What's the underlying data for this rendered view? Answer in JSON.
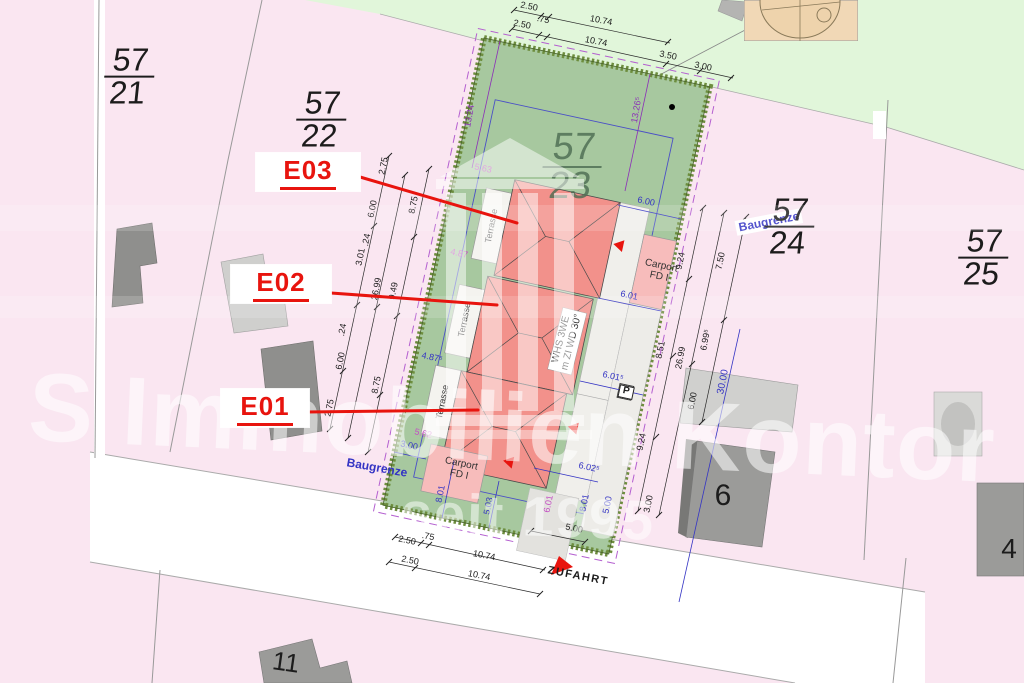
{
  "colors": {
    "ink": "#1c1c1c",
    "ink2": "#333333",
    "blue": "#3434c4",
    "purple": "#8c2fb8",
    "magenta": "#c44fc4",
    "red": "#e8140e",
    "green_label": "#4b6b51",
    "pink_parcel": "#fae6f1",
    "green_area": "#e1f6da",
    "lawn": "#a7c89f",
    "hedge": "#6d8d3e",
    "roof": "#f2918b",
    "carport": "#f7bcbb",
    "building_dark": "#9b9b99",
    "building_light": "#d0d0ce",
    "street": "#ffffff"
  },
  "watermark": {
    "brand": "S Immobilien Kontor",
    "since": "seit 1995"
  },
  "parcels": [
    {
      "n": "parcel-label-57-21",
      "num": "57",
      "den": "21",
      "x": 129,
      "y": 77,
      "s": 32,
      "c": "#1c1c1c",
      "o": 1
    },
    {
      "n": "parcel-label-57-22",
      "num": "57",
      "den": "22",
      "x": 321,
      "y": 120,
      "s": 32,
      "c": "#1c1c1c",
      "o": 1
    },
    {
      "n": "parcel-label-57-23",
      "num": "57",
      "den": "23",
      "x": 572,
      "y": 167,
      "s": 38,
      "c": "#4b6b51",
      "o": 0.8
    },
    {
      "n": "parcel-label-57-24",
      "num": "57",
      "den": "24",
      "x": 789,
      "y": 227,
      "s": 32,
      "c": "#1c1c1c",
      "o": 1
    },
    {
      "n": "parcel-label-57-25",
      "num": "57",
      "den": "25",
      "x": 983,
      "y": 258,
      "s": 32,
      "c": "#1c1c1c",
      "o": 1
    }
  ],
  "units": [
    {
      "n": "unit-label-e03",
      "t": "E03",
      "x": 308,
      "y": 172,
      "w": 104,
      "h": 38
    },
    {
      "n": "unit-label-e02",
      "t": "E02",
      "x": 281,
      "y": 284,
      "w": 100,
      "h": 38
    },
    {
      "n": "unit-label-e01",
      "t": "E01",
      "x": 265,
      "y": 408,
      "w": 88,
      "h": 38
    }
  ],
  "labels": [
    {
      "n": "dim-top-1",
      "t": "2.50",
      "x": 529,
      "y": 7,
      "r": 11,
      "s": 9,
      "c": "ink"
    },
    {
      "n": "dim-top-2",
      "t": "10.74",
      "x": 601,
      "y": 21,
      "r": 11,
      "s": 9,
      "c": "ink"
    },
    {
      "n": "dim-top-3",
      "t": "2.50",
      "x": 522,
      "y": 25,
      "r": 11,
      "s": 9,
      "c": "ink"
    },
    {
      "n": "dim-top-4",
      "t": ".75",
      "x": 543,
      "y": 20,
      "r": 11,
      "s": 9,
      "c": "ink"
    },
    {
      "n": "dim-top-5",
      "t": "10.74",
      "x": 596,
      "y": 42,
      "r": 11,
      "s": 9,
      "c": "ink"
    },
    {
      "n": "dim-top-6",
      "t": "3.50",
      "x": 668,
      "y": 56,
      "r": 11,
      "s": 9,
      "c": "ink"
    },
    {
      "n": "dim-top-7",
      "t": "3.00",
      "x": 703,
      "y": 67,
      "r": 11,
      "s": 9,
      "c": "ink"
    },
    {
      "n": "dim-left-1",
      "t": "2.75",
      "x": 384,
      "y": 166,
      "r": -79,
      "s": 9,
      "c": "ink"
    },
    {
      "n": "dim-left-2",
      "t": "6.00",
      "x": 373,
      "y": 209,
      "r": -79,
      "s": 9,
      "c": "ink"
    },
    {
      "n": "dim-left-3",
      "t": "8.75",
      "x": 414,
      "y": 205,
      "r": -79,
      "s": 9,
      "c": "ink"
    },
    {
      "n": "dim-left-4",
      "t": ".24",
      "x": 367,
      "y": 240,
      "r": -79,
      "s": 9,
      "c": "ink"
    },
    {
      "n": "dim-left-5",
      "t": "3.01",
      "x": 361,
      "y": 257,
      "r": -79,
      "s": 9,
      "c": "ink"
    },
    {
      "n": "dim-left-6",
      "t": "26.99",
      "x": 377,
      "y": 289,
      "r": -79,
      "s": 9,
      "c": "ink"
    },
    {
      "n": "dim-left-7",
      "t": "9.49",
      "x": 394,
      "y": 291,
      "r": -79,
      "s": 9,
      "c": "ink"
    },
    {
      "n": "dim-left-8",
      "t": ".24",
      "x": 343,
      "y": 330,
      "r": -79,
      "s": 9,
      "c": "ink"
    },
    {
      "n": "dim-left-9",
      "t": "6.00",
      "x": 341,
      "y": 361,
      "r": -79,
      "s": 9,
      "c": "ink"
    },
    {
      "n": "dim-left-10",
      "t": "8.75",
      "x": 377,
      "y": 385,
      "r": -79,
      "s": 9,
      "c": "ink"
    },
    {
      "n": "dim-left-11",
      "t": "2.75",
      "x": 330,
      "y": 408,
      "r": -79,
      "s": 9,
      "c": "ink"
    },
    {
      "n": "dim-right-1",
      "t": "9.24",
      "x": 681,
      "y": 261,
      "r": -79,
      "s": 9,
      "c": "ink"
    },
    {
      "n": "dim-right-2",
      "t": "7.50",
      "x": 721,
      "y": 261,
      "r": -79,
      "s": 9,
      "c": "ink"
    },
    {
      "n": "dim-right-3",
      "t": "8.51",
      "x": 661,
      "y": 350,
      "r": -79,
      "s": 9,
      "c": "ink"
    },
    {
      "n": "dim-right-4",
      "t": "26.99",
      "x": 681,
      "y": 358,
      "r": -79,
      "s": 9,
      "c": "ink"
    },
    {
      "n": "dim-right-5",
      "t": "6.99⁵",
      "x": 706,
      "y": 340,
      "r": -79,
      "s": 9,
      "c": "ink"
    },
    {
      "n": "dim-right-6",
      "t": "6.00",
      "x": 693,
      "y": 401,
      "r": -79,
      "s": 9,
      "c": "ink"
    },
    {
      "n": "dim-right-7",
      "t": "9.24",
      "x": 642,
      "y": 442,
      "r": -79,
      "s": 9,
      "c": "ink"
    },
    {
      "n": "dim-right-8",
      "t": "3.00",
      "x": 649,
      "y": 504,
      "r": -79,
      "s": 9,
      "c": "ink"
    },
    {
      "n": "dim-bottom-1",
      "t": "2.50",
      "x": 407,
      "y": 541,
      "r": 11,
      "s": 9,
      "c": "ink"
    },
    {
      "n": "dim-bottom-2",
      "t": ".75",
      "x": 428,
      "y": 537,
      "r": 11,
      "s": 9,
      "c": "ink"
    },
    {
      "n": "dim-bottom-3",
      "t": "10.74",
      "x": 484,
      "y": 556,
      "r": 11,
      "s": 9,
      "c": "ink"
    },
    {
      "n": "dim-bottom-4",
      "t": "2.50",
      "x": 410,
      "y": 561,
      "r": 11,
      "s": 9,
      "c": "ink"
    },
    {
      "n": "dim-bottom-5",
      "t": "10.74",
      "x": 479,
      "y": 576,
      "r": 11,
      "s": 9,
      "c": "ink"
    },
    {
      "n": "dim-bottom-6",
      "t": "5.00",
      "x": 574,
      "y": 529,
      "r": 11,
      "s": 9,
      "c": "ink"
    },
    {
      "n": "street-zufahrt-label",
      "t": "ZUFAHRT",
      "x": 578,
      "y": 577,
      "r": 11,
      "s": 11,
      "c": "ink",
      "b": 1,
      "ls": 1.5
    },
    {
      "n": "dim-blue-1",
      "t": "6.00",
      "x": 646,
      "y": 202,
      "r": 12,
      "s": 9,
      "c": "blue"
    },
    {
      "n": "dim-blue-2",
      "t": "6.01",
      "x": 629,
      "y": 296,
      "r": 12,
      "s": 9,
      "c": "blue"
    },
    {
      "n": "dim-blue-3",
      "t": "6.01⁵",
      "x": 613,
      "y": 377,
      "r": 12,
      "s": 9,
      "c": "blue"
    },
    {
      "n": "dim-blue-4",
      "t": "6.02⁵",
      "x": 589,
      "y": 468,
      "r": 12,
      "s": 9,
      "c": "blue"
    },
    {
      "n": "dim-blue-5",
      "t": "3.00",
      "x": 409,
      "y": 446,
      "r": 12,
      "s": 9,
      "c": "blue"
    },
    {
      "n": "dim-blue-6",
      "t": "8.01",
      "x": 441,
      "y": 494,
      "r": -79,
      "s": 9,
      "c": "blue"
    },
    {
      "n": "dim-blue-7",
      "t": "5.03",
      "x": 489,
      "y": 506,
      "r": -79,
      "s": 9,
      "c": "blue"
    },
    {
      "n": "dim-blue-8",
      "t": "8.01",
      "x": 585,
      "y": 503,
      "r": -79,
      "s": 9,
      "c": "blue"
    },
    {
      "n": "dim-blue-9",
      "t": "5.00",
      "x": 608,
      "y": 505,
      "r": -79,
      "s": 9,
      "c": "blue"
    },
    {
      "n": "dim-blue-10",
      "t": "30.00",
      "x": 724,
      "y": 382,
      "r": -79,
      "s": 10,
      "c": "blue"
    },
    {
      "n": "dim-blue-11",
      "t": "4.87⁵",
      "x": 432,
      "y": 358,
      "r": 12,
      "s": 9,
      "c": "blue"
    },
    {
      "n": "dim-purple-1",
      "t": "13.24",
      "x": 470,
      "y": 116,
      "r": -80,
      "s": 9,
      "c": "purple"
    },
    {
      "n": "dim-purple-2",
      "t": "13.26⁵",
      "x": 637,
      "y": 110,
      "r": -80,
      "s": 9,
      "c": "purple"
    },
    {
      "n": "dim-magenta-1",
      "t": "5.63",
      "x": 483,
      "y": 169,
      "r": 12,
      "s": 9,
      "c": "magenta"
    },
    {
      "n": "dim-magenta-2",
      "t": "4.87",
      "x": 459,
      "y": 254,
      "r": 12,
      "s": 9,
      "c": "magenta"
    },
    {
      "n": "dim-magenta-3",
      "t": "5.62",
      "x": 423,
      "y": 434,
      "r": 12,
      "s": 9,
      "c": "magenta"
    },
    {
      "n": "dim-magenta-4",
      "t": "6.01",
      "x": 549,
      "y": 504,
      "r": -79,
      "s": 9,
      "c": "magenta"
    },
    {
      "n": "baugrenze-label-top",
      "t": "Baugrenze",
      "x": 769,
      "y": 222,
      "r": -11,
      "s": 12,
      "c": "blue",
      "b": 1,
      "bg": "#ffffff"
    },
    {
      "n": "baugrenze-label-bottom",
      "t": "Baugrenze",
      "x": 377,
      "y": 468,
      "r": 10,
      "s": 12,
      "c": "blue",
      "b": 1
    },
    {
      "n": "terrace-label-1",
      "t": "Terrasse",
      "x": 492,
      "y": 226,
      "r": -79,
      "s": 9,
      "c": "ink2"
    },
    {
      "n": "terrace-label-2",
      "t": "Terrasse",
      "x": 465,
      "y": 320,
      "r": -79,
      "s": 9,
      "c": "ink2"
    },
    {
      "n": "terrace-label-3",
      "t": "Terrasse",
      "x": 443,
      "y": 402,
      "r": -79,
      "s": 9,
      "c": "ink2"
    },
    {
      "n": "carport-label-top",
      "t": "Carport\nFD I",
      "x": 660,
      "y": 272,
      "r": 12,
      "s": 10,
      "c": "ink2"
    },
    {
      "n": "carport-label-bottom",
      "t": "Carport\nFD I",
      "x": 460,
      "y": 470,
      "r": 12,
      "s": 10,
      "c": "ink2"
    },
    {
      "n": "house-type-label",
      "t": "WHS 3WE\nm ZI WD 30°",
      "x": 567,
      "y": 341,
      "r": -76,
      "s": 10,
      "c": "ink2",
      "bg": "#ffffff",
      "bd": 1
    },
    {
      "n": "parking-symbol",
      "t": "P",
      "x": 626,
      "y": 392,
      "r": 12,
      "s": 10,
      "c": "ink",
      "b": 1,
      "box": 1
    },
    {
      "n": "house-number-6",
      "t": "6",
      "x": 723,
      "y": 496,
      "r": 0,
      "s": 30,
      "c": "ink"
    },
    {
      "n": "house-number-11",
      "t": "11",
      "x": 286,
      "y": 662,
      "r": 8,
      "s": 26,
      "c": "ink"
    },
    {
      "n": "house-number-4",
      "t": "4",
      "x": 1009,
      "y": 549,
      "r": 0,
      "s": 28,
      "c": "ink"
    }
  ]
}
